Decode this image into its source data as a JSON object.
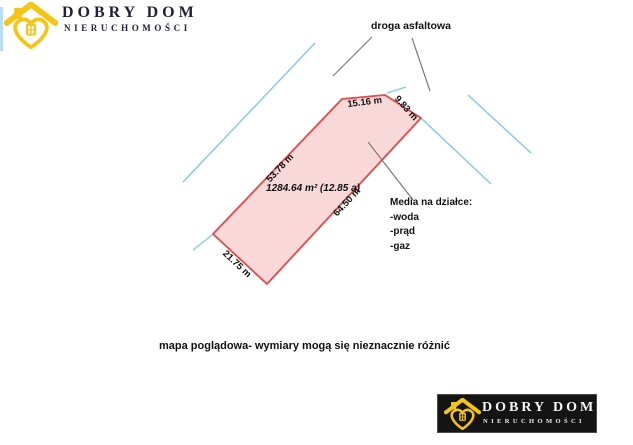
{
  "brand": {
    "name": "DOBRY DOM",
    "tagline": "NIERUCHOMOŚCI"
  },
  "footer_brand": {
    "name": "DOBRY DOM",
    "tagline": "NIERUCHOMOŚCI"
  },
  "map": {
    "road_label": "droga asfaltowa",
    "area_label": "1284.64 m² (12.85 a)",
    "dimensions": {
      "top": "15.16 m",
      "top_right": "9.83 m",
      "left": "53.78 m",
      "right": "64.50 m",
      "bottom": "21.75 m"
    },
    "media": {
      "title": "Media na działce:",
      "items": [
        "-woda",
        "-prąd",
        "-gaz"
      ]
    },
    "disclaimer": "mapa poglądowa- wymiary mogą się nieznacznie różnić"
  },
  "colors": {
    "plot_fill": "#f9d8d9",
    "plot_border": "#e04a4a",
    "road_line": "#7fc8ef",
    "pointer_line": "#7a7a7a",
    "brand_gold": "#f5c417",
    "brand_dark": "#201f35",
    "footer_bg": "#141414"
  }
}
